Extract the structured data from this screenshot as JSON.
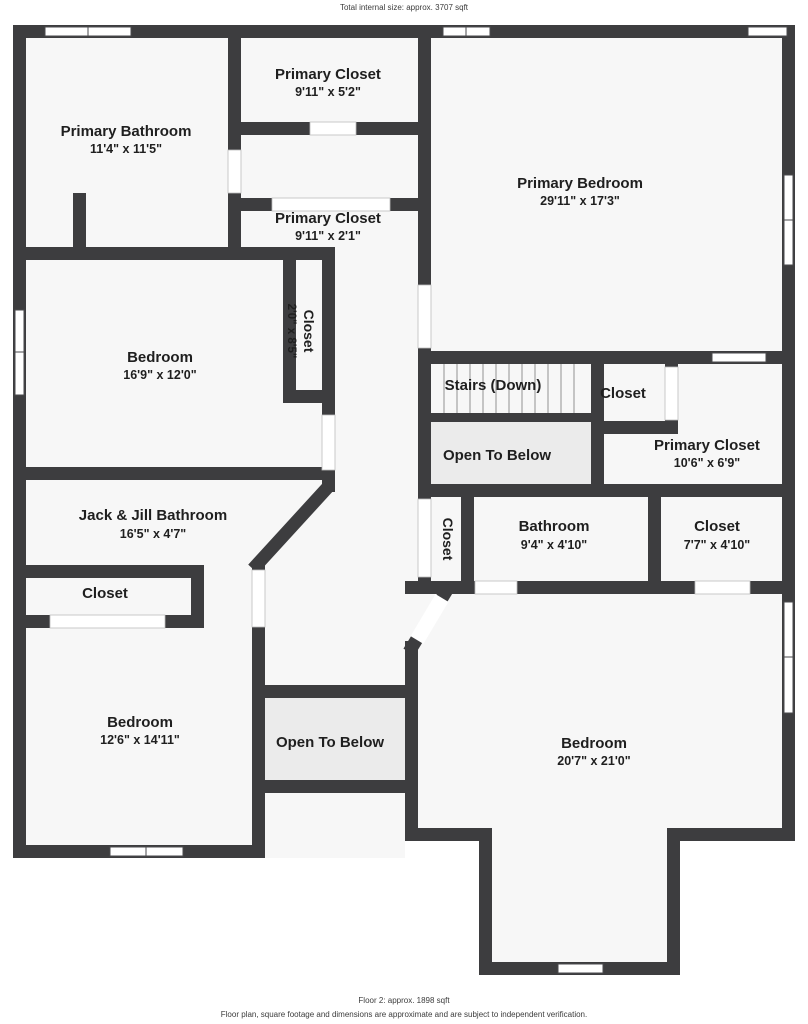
{
  "header": {
    "total": "Total internal size: approx. 3707 sqft"
  },
  "footer": {
    "floor": "Floor 2: approx. 1898 sqft",
    "disclaimer": "Floor plan, square footage and dimensions are approximate and are subject to independent verification."
  },
  "colors": {
    "wall": "#3d3d3f",
    "floor": "#f7f7f7",
    "void": "#ebebeb",
    "text": "#1f1f1f"
  },
  "rooms": {
    "primary_closet_top": {
      "label": "Primary Closet",
      "dims": "9'11\" x 5'2\""
    },
    "primary_bathroom": {
      "label": "Primary Bathroom",
      "dims": "11'4\" x 11'5\""
    },
    "primary_bedroom": {
      "label": "Primary Bedroom",
      "dims": "29'11\" x 17'3\""
    },
    "primary_closet_mid": {
      "label": "Primary Closet",
      "dims": "9'11\" x 2'1\""
    },
    "closet_sliver": {
      "label": "Closet",
      "dims": "2'0\" x 8'5\""
    },
    "bedroom_left": {
      "label": "Bedroom",
      "dims": "16'9\" x 12'0\""
    },
    "stairs": {
      "label": "Stairs (Down)"
    },
    "closet_stairs": {
      "label": "Closet"
    },
    "open_below_stairs": {
      "label": "Open To Below"
    },
    "primary_closet_right": {
      "label": "Primary Closet",
      "dims": "10'6\" x 6'9\""
    },
    "jack_jill": {
      "label": "Jack & Jill Bathroom",
      "dims": "16'5\" x 4'7\""
    },
    "closet_hall": {
      "label": "Closet"
    },
    "bathroom_mid": {
      "label": "Bathroom",
      "dims": "9'4\" x 4'10\""
    },
    "closet_mid_right": {
      "label": "Closet",
      "dims": "7'7\" x 4'10\""
    },
    "closet_bottom_left": {
      "label": "Closet"
    },
    "bedroom_bottom_left": {
      "label": "Bedroom",
      "dims": "12'6\" x 14'11\""
    },
    "open_below_center": {
      "label": "Open To Below"
    },
    "bedroom_bottom_right": {
      "label": "Bedroom",
      "dims": "20'7\" x 21'0\""
    }
  }
}
